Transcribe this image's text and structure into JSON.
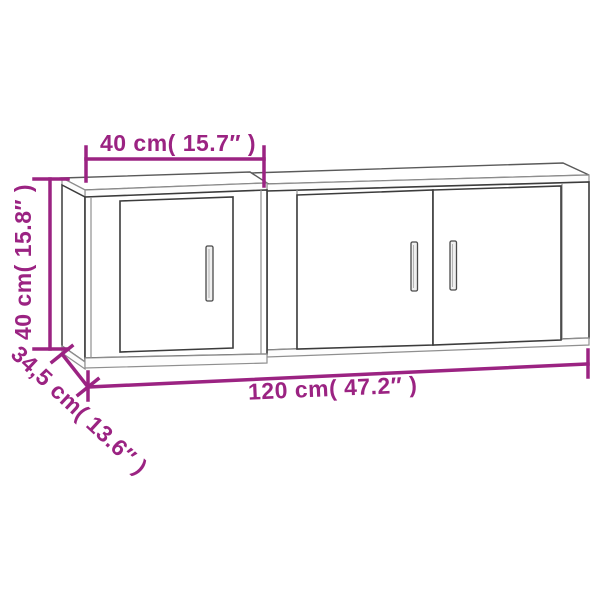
{
  "image": {
    "background_color": "#ffffff",
    "accent_color": "#9B2382",
    "outline_color": "#3c3c3c",
    "light_line_color": "#8f8f8f",
    "subject": "wall-mounted cabinet set line drawing",
    "cabinets": [
      {
        "name": "left cabinet",
        "doors": 1,
        "handles": 1
      },
      {
        "name": "right cabinet",
        "doors": 2,
        "handles": 2
      }
    ],
    "dimensions": {
      "upper_width_label": "40 cm( 15.7″ )",
      "height_label": "40 cm( 15.8″ )",
      "depth_label": "34,5 cm( 13.6″ )",
      "total_width_label": "120 cm( 47.2″ )"
    }
  }
}
